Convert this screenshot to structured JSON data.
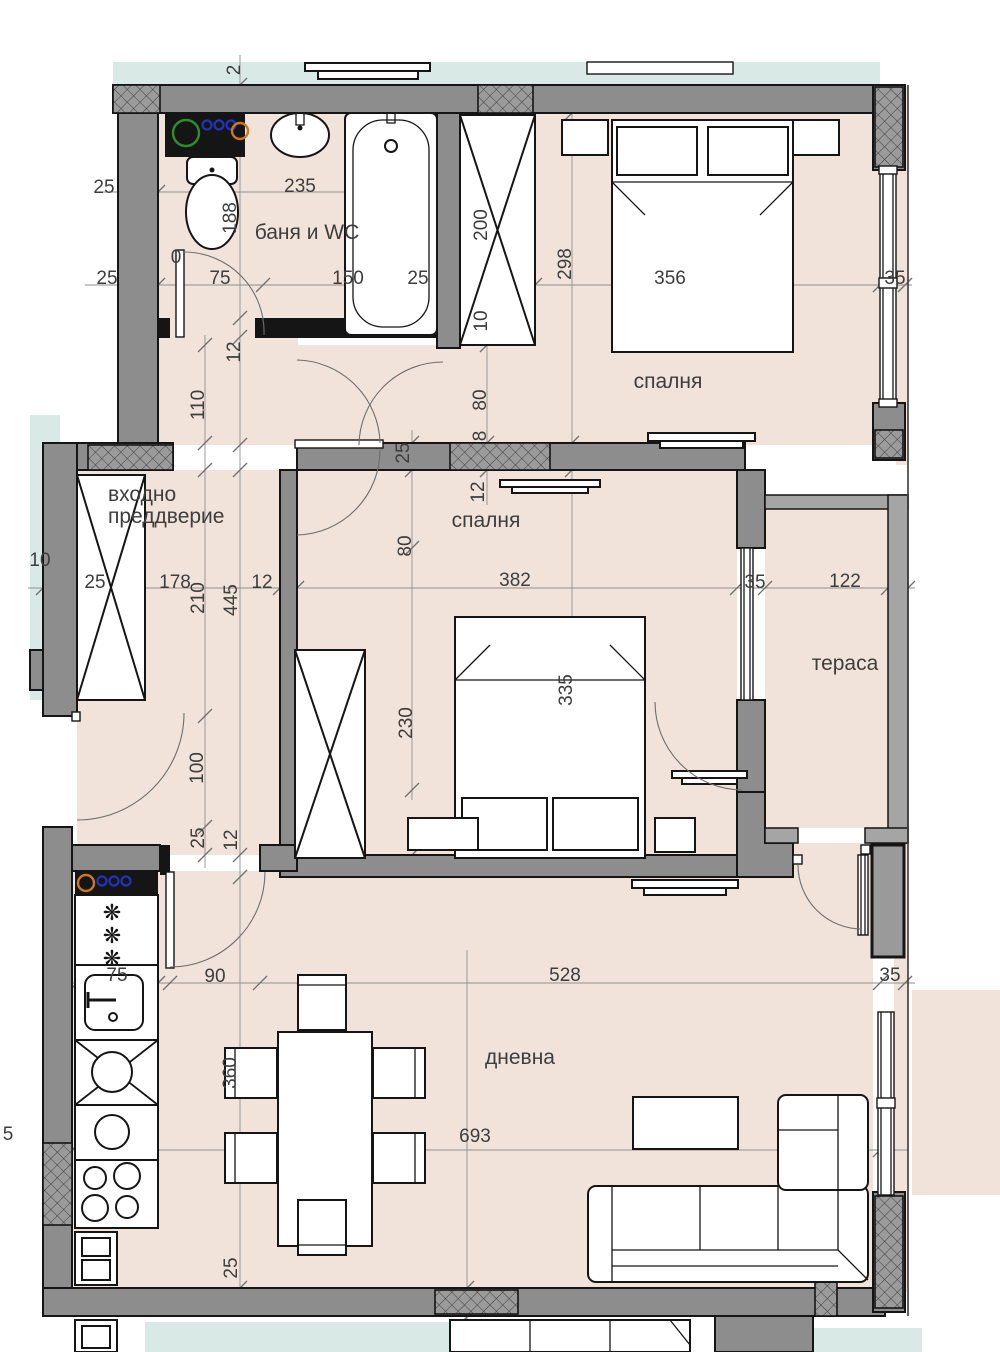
{
  "title": "План на апартамент — дневна, две спални, баня и WC, тераса",
  "colors": {
    "wall": "#8d8d8d",
    "wall_light": "#a5a5a5",
    "edge": "#151515",
    "room": "#f2e3da",
    "glass": "#d9eae6",
    "dimline": "#8f8f8f",
    "dimtext": "#3d3d3d",
    "hatch_bg": "#9b9b9b",
    "hatch_line": "#3f3f3f",
    "fixture_green": "#2e8b2e",
    "fixture_blue": "#2233bb",
    "fixture_orange": "#cc7722"
  },
  "rooms": [
    {
      "id": "bathroom",
      "label": "баня и WC",
      "x": 307,
      "y": 239
    },
    {
      "id": "bedroom-1",
      "label": "спалня",
      "x": 668,
      "y": 388
    },
    {
      "id": "bedroom-2",
      "label": "спалня",
      "x": 486,
      "y": 527
    },
    {
      "id": "entrance-hall",
      "label": "входно преддверие",
      "lines": [
        "входно",
        "преддверие"
      ],
      "x": 108,
      "y": 501,
      "anchor": "start"
    },
    {
      "id": "terrace",
      "label": "тераса",
      "x": 845,
      "y": 670
    },
    {
      "id": "living-room",
      "label": "дневна",
      "x": 520,
      "y": 1064
    }
  ],
  "dimensions": [
    {
      "t": "2",
      "x": 240,
      "y": 70,
      "r": -90
    },
    {
      "t": "25",
      "x": 104,
      "y": 193
    },
    {
      "t": "235",
      "x": 300,
      "y": 192
    },
    {
      "t": "188",
      "x": 236,
      "y": 218,
      "r": -90
    },
    {
      "t": "200",
      "x": 487,
      "y": 225,
      "r": -90
    },
    {
      "t": "10",
      "x": 487,
      "y": 321,
      "r": -90
    },
    {
      "t": "298",
      "x": 571,
      "y": 264,
      "r": -90
    },
    {
      "t": "25",
      "x": 107,
      "y": 284
    },
    {
      "t": "75",
      "x": 220,
      "y": 284
    },
    {
      "t": "150",
      "x": 348,
      "y": 284
    },
    {
      "t": "25",
      "x": 418,
      "y": 284
    },
    {
      "t": "356",
      "x": 670,
      "y": 284
    },
    {
      "t": "35",
      "x": 895,
      "y": 284
    },
    {
      "t": "12",
      "x": 240,
      "y": 352,
      "r": -90
    },
    {
      "t": "110",
      "x": 204,
      "y": 405,
      "r": -90
    },
    {
      "t": "0",
      "x": 176,
      "y": 263
    },
    {
      "t": "80",
      "x": 486,
      "y": 400,
      "r": -90
    },
    {
      "t": "8",
      "x": 486,
      "y": 436,
      "r": -90
    },
    {
      "t": "12",
      "x": 484,
      "y": 492,
      "r": -90
    },
    {
      "t": "25",
      "x": 409,
      "y": 453,
      "r": -90
    },
    {
      "t": "80",
      "x": 411,
      "y": 546,
      "r": -90
    },
    {
      "t": "10",
      "x": 40,
      "y": 566
    },
    {
      "t": "25",
      "x": 95,
      "y": 588
    },
    {
      "t": "178",
      "x": 175,
      "y": 588
    },
    {
      "t": "210",
      "x": 204,
      "y": 598,
      "r": -90
    },
    {
      "t": "445",
      "x": 237,
      "y": 600,
      "r": -90
    },
    {
      "t": "12",
      "x": 262,
      "y": 588
    },
    {
      "t": "382",
      "x": 515,
      "y": 586
    },
    {
      "t": "35",
      "x": 755,
      "y": 588
    },
    {
      "t": "122",
      "x": 845,
      "y": 587
    },
    {
      "t": "335",
      "x": 572,
      "y": 690,
      "r": -90
    },
    {
      "t": "230",
      "x": 412,
      "y": 723,
      "r": -90
    },
    {
      "t": "100",
      "x": 203,
      "y": 768,
      "r": -90
    },
    {
      "t": "25",
      "x": 204,
      "y": 838,
      "r": -90
    },
    {
      "t": "12",
      "x": 237,
      "y": 840,
      "r": -90
    },
    {
      "t": "75",
      "x": 117,
      "y": 981
    },
    {
      "t": "90",
      "x": 215,
      "y": 982
    },
    {
      "t": "528",
      "x": 565,
      "y": 981
    },
    {
      "t": "35",
      "x": 890,
      "y": 981
    },
    {
      "t": "360",
      "x": 236,
      "y": 1073,
      "r": -90
    },
    {
      "t": "693",
      "x": 475,
      "y": 1142
    },
    {
      "t": "5",
      "x": 8,
      "y": 1140
    },
    {
      "t": "25",
      "x": 237,
      "y": 1268,
      "r": -90
    }
  ]
}
